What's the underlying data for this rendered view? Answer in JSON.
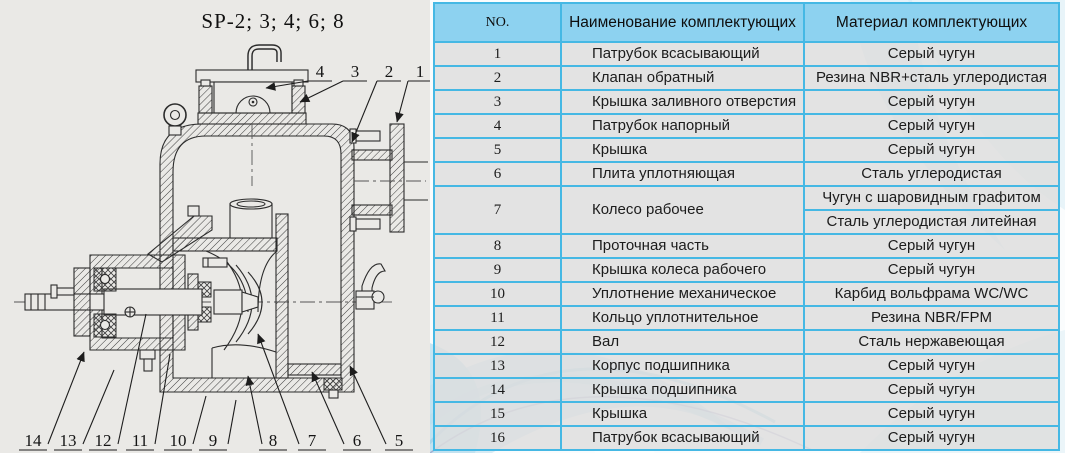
{
  "diagram": {
    "title": "SP-2; 3; 4; 6; 8",
    "callouts_top": [
      "4",
      "3",
      "2",
      "1"
    ],
    "callouts_bottom": [
      "14",
      "13",
      "12",
      "11",
      "10",
      "9",
      "8",
      "7",
      "6",
      "5"
    ]
  },
  "table": {
    "headers": [
      "NO.",
      "Наименование комплектующих",
      "Материал комплектующих"
    ],
    "rows": [
      {
        "no": "1",
        "name": "Патрубок всасывающий",
        "material": "Серый чугун"
      },
      {
        "no": "2",
        "name": "Клапан обратный",
        "material": "Резина NBR+сталь углеродистая"
      },
      {
        "no": "3",
        "name": "Крышка заливного отверстия",
        "material": "Серый чугун"
      },
      {
        "no": "4",
        "name": "Патрубок напорный",
        "material": "Серый чугун"
      },
      {
        "no": "5",
        "name": "Крышка",
        "material": "Серый чугун"
      },
      {
        "no": "6",
        "name": "Плита уплотняющая",
        "material": "Сталь углеродистая"
      },
      {
        "no": "7",
        "name": "Колесо рабочее",
        "materials": [
          "Чугун с шаровидным графитом",
          "Сталь углеродистая литейная"
        ]
      },
      {
        "no": "8",
        "name": "Проточная часть",
        "material": "Серый чугун"
      },
      {
        "no": "9",
        "name": "Крышка колеса рабочего",
        "material": "Серый чугун"
      },
      {
        "no": "10",
        "name": "Уплотнение механическое",
        "material": "Карбид вольфрама WC/WC"
      },
      {
        "no": "11",
        "name": "Кольцо уплотнительное",
        "material": "Резина NBR/FPM"
      },
      {
        "no": "12",
        "name": "Вал",
        "material": "Сталь нержавеющая"
      },
      {
        "no": "13",
        "name": "Корпус подшипника",
        "material": "Серый чугун"
      },
      {
        "no": "14",
        "name": "Крышка подшипника",
        "material": "Серый чугун"
      },
      {
        "no": "15",
        "name": "Крышка",
        "material": "Серый чугун"
      },
      {
        "no": "16",
        "name": "Патрубок всасывающий",
        "material": "Серый чугун"
      }
    ]
  },
  "colors": {
    "header_bg": "#8dd2f0",
    "table_border": "#45b8e4",
    "row_bg": "#dedede",
    "drawing_bg": "#eae9e6",
    "wave_accent": "#a8d4e9"
  }
}
